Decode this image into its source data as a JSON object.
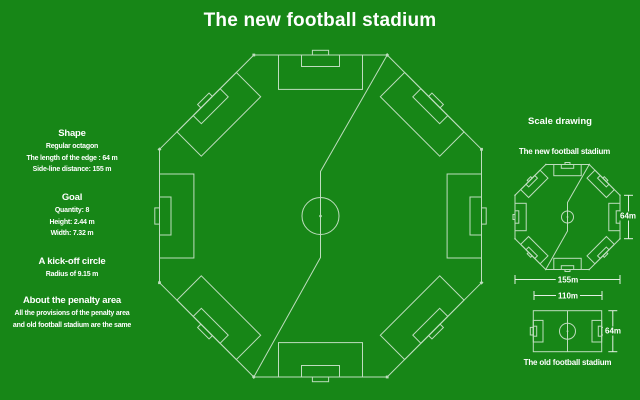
{
  "title": "The new football stadium",
  "colors": {
    "bg": "#178617",
    "line": "#beddbe",
    "dim": "#e3f0e3",
    "text": "#ffffff"
  },
  "left_panel": {
    "sections": [
      {
        "heading": "Shape",
        "lines": [
          "Regular octagon",
          "The length of the edge : 64 m",
          "Side-line distance: 155 m"
        ]
      },
      {
        "heading": "Goal",
        "lines": [
          "Quantity: 8",
          "Height: 2.44 m",
          "Width: 7.32 m"
        ]
      },
      {
        "heading": "A kick-off circle",
        "lines": [
          "Radius of 9.15 m"
        ]
      },
      {
        "heading": "About the penalty area",
        "lines": [
          "All the provisions of the penalty area",
          "and old football stadium are the same"
        ]
      }
    ]
  },
  "scale_panel": {
    "heading": "Scale drawing",
    "new_label": "The new football stadium",
    "old_label": "The old football stadium",
    "dim_edge": "64m",
    "dim_width": "155m",
    "dim_old_length": "110m",
    "dim_old_width": "64m"
  }
}
